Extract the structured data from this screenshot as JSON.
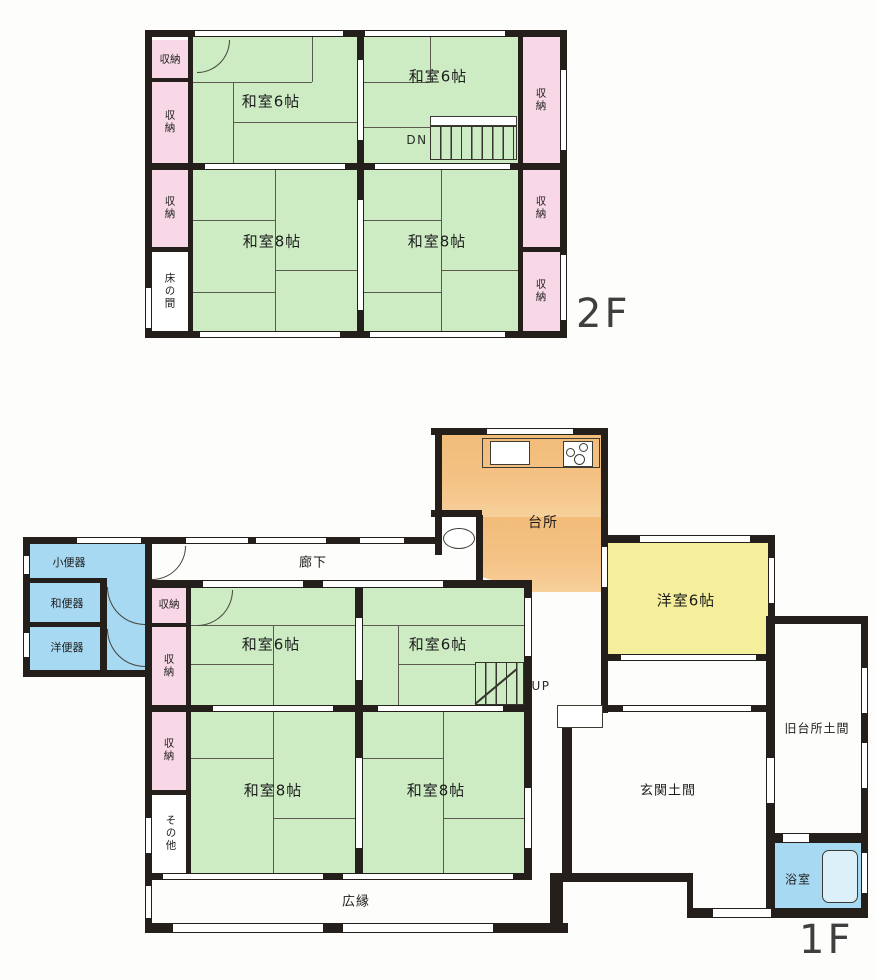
{
  "floor2": {
    "label": "2F",
    "rooms": {
      "washitsu6_a": "和室6帖",
      "washitsu6_b": "和室6帖",
      "washitsu8_a": "和室8帖",
      "washitsu8_b": "和室8帖",
      "tokonoma": "床の間",
      "closet_l1": "収納",
      "closet_l2": "収納",
      "closet_l3": "収納",
      "closet_r1": "収納",
      "closet_r2": "収納",
      "closet_r3": "収納",
      "stairs_down": "DN"
    }
  },
  "floor1": {
    "label": "1F",
    "rooms": {
      "rouka": "廊下",
      "daidokoro": "台所",
      "yoshitsu6": "洋室6帖",
      "washitsu6_a": "和室6帖",
      "washitsu6_b": "和室6帖",
      "washitsu8_a": "和室8帖",
      "washitsu8_b": "和室8帖",
      "closet_1": "収納",
      "closet_2": "収納",
      "closet_3": "収納",
      "sonota": "その他",
      "hiroen": "広縁",
      "genkan_doma": "玄関土間",
      "kyu_daidokoro_doma": "旧台所土間",
      "yokushitsu": "浴室",
      "shobenki": "小便器",
      "wabenki": "和便器",
      "yobenki": "洋便器",
      "stairs_up": "UP"
    }
  },
  "colors": {
    "tatami_green": "#cdecc3",
    "closet_pink": "#f8d8e6",
    "water_blue": "#a8d9f2",
    "kitchen_orange": "#f4c183",
    "western_yellow": "#f5ef9c",
    "wall": "#241f1a"
  }
}
